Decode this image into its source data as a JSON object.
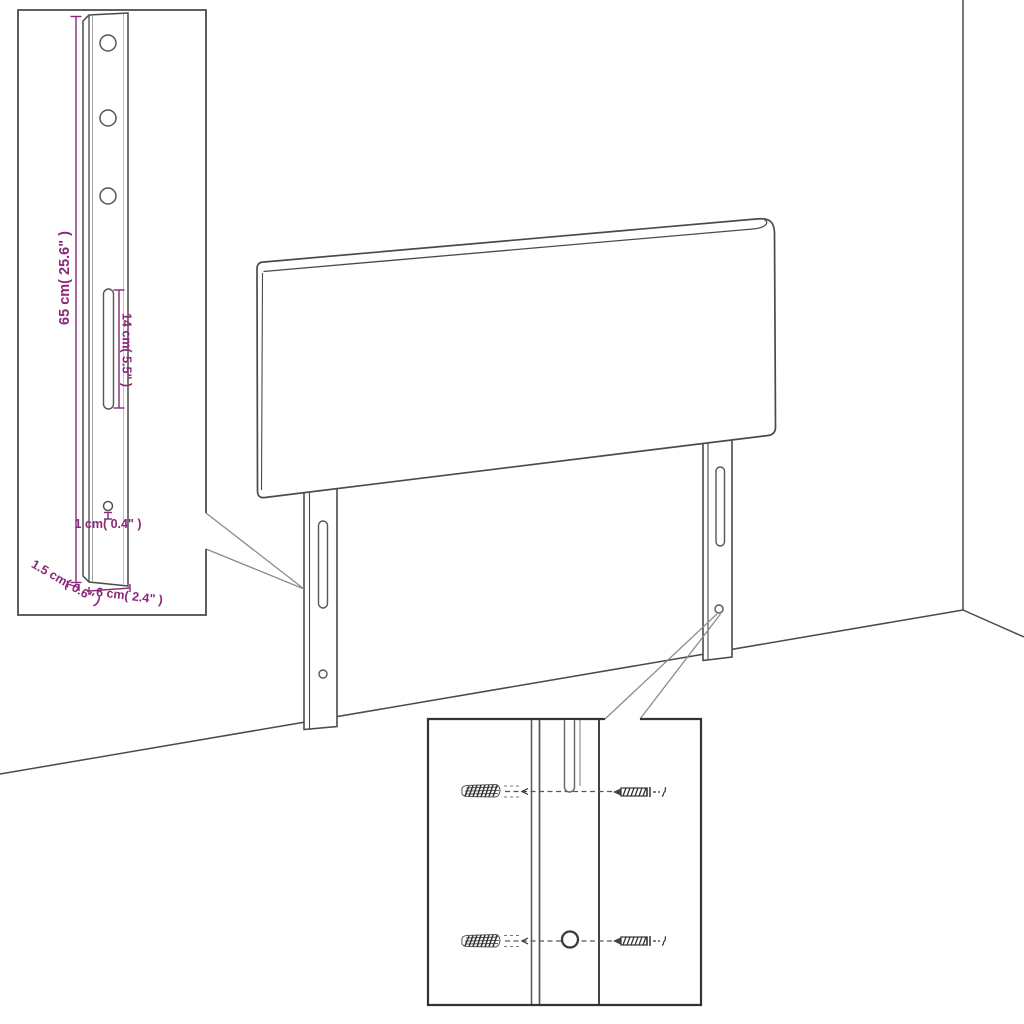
{
  "diagram": {
    "type": "furniture-assembly-illustration",
    "subject": "upholstered headboard with two adjustable mounting legs standing against a wall corner",
    "background": "#ffffff",
    "colors": {
      "line": "#4a4a4a",
      "dimension_accent": "#8b2878",
      "inset_border": "#3f3f3f",
      "leader_line": "#8c8c8c"
    },
    "labels": {
      "bracket_height": "65 cm( 25.6\" )",
      "slot_length": "14 cm( 5.5\" )",
      "hole_size": "1 cm( 0.4\" )",
      "bracket_depth": "1.5 cm( 0.6\" )",
      "bracket_width": "6 cm( 2.4\" )"
    },
    "insets": {
      "bracket_detail": {
        "content": "mounting leg bracket with 3 round holes, long adjustment slot and small lower hole",
        "hole_count": 3,
        "dimension_count": 5
      },
      "mounting_detail": {
        "content": "leg channel front view with wall anchors and screws aligned to slot and hole",
        "rows": 2,
        "parts": [
          {
            "name": "wall-anchor"
          },
          {
            "name": "screw"
          }
        ]
      }
    }
  }
}
